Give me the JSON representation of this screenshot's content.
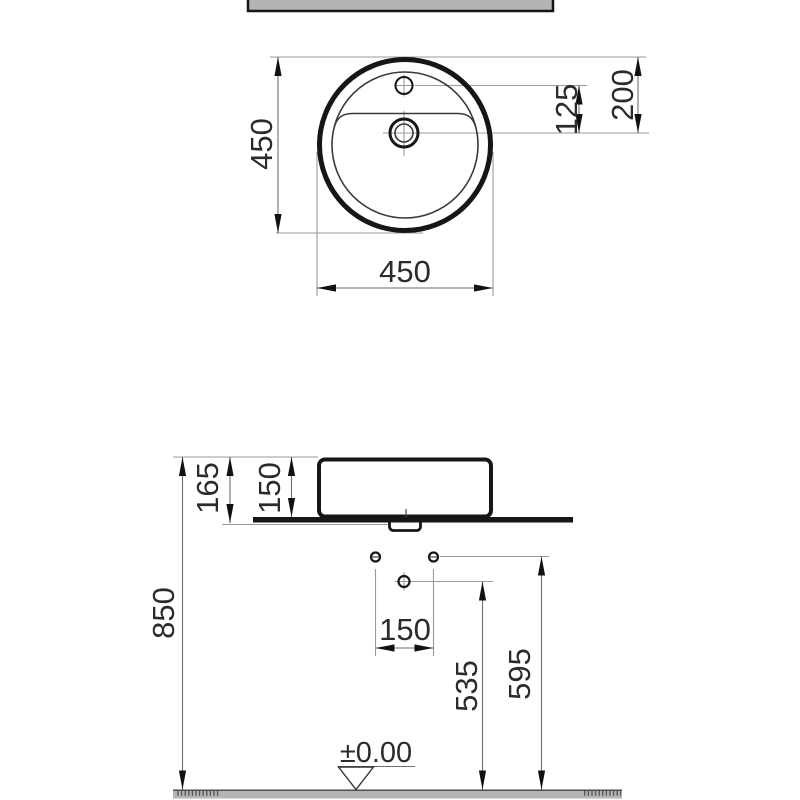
{
  "drawing_labels": {
    "top_view": {
      "overall_height": "450",
      "overall_width": "450",
      "tap_hole_to_drain": "125",
      "front_edge_to_drain": "200"
    },
    "side_view": {
      "rim_height_incl_counter": "165",
      "basin_body_height": "150",
      "counter_top_height": "850",
      "wall_hole_spacing": "150",
      "drain_centre_height": "535",
      "water_inlet_height": "595",
      "floor_datum": "±0.00"
    },
    "colors": {
      "outline": "#161616",
      "dimension_line": "#6e6e6e",
      "extension_line": "#9a9a9a",
      "section_fill": "#b4b4b4"
    }
  }
}
